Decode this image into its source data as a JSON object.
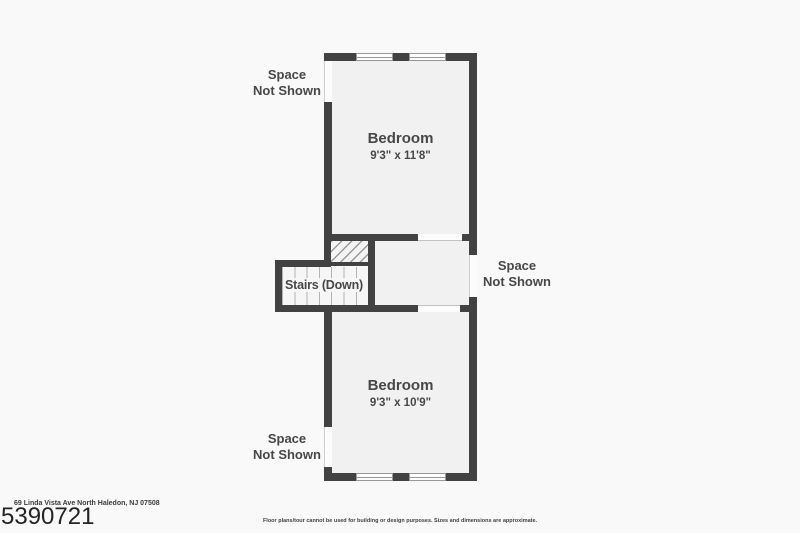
{
  "plan": {
    "top_bedroom": {
      "name": "Bedroom",
      "dims": "9'3\" x 11'8\""
    },
    "bottom_bedroom": {
      "name": "Bedroom",
      "dims": "9'3\" x 10'9\""
    },
    "stairs_label": "Stairs (Down)",
    "space_not_shown": {
      "top_left": "Space\nNot Shown",
      "right": "Space\nNot Shown",
      "bottom_left": "Space\nNot Shown"
    }
  },
  "footer": {
    "address": "69 Linda Vista Ave North Haledon, NJ 07508",
    "listing_id": "5390721",
    "disclaimer": "Floor plans/tour cannot be used for building or design purposes. Sizes and dimensions are approximate."
  },
  "colors": {
    "wall": "#424242",
    "room_fill": "#f1f1f1",
    "page_background": "#f9f9f9",
    "label_text": "#474747"
  }
}
